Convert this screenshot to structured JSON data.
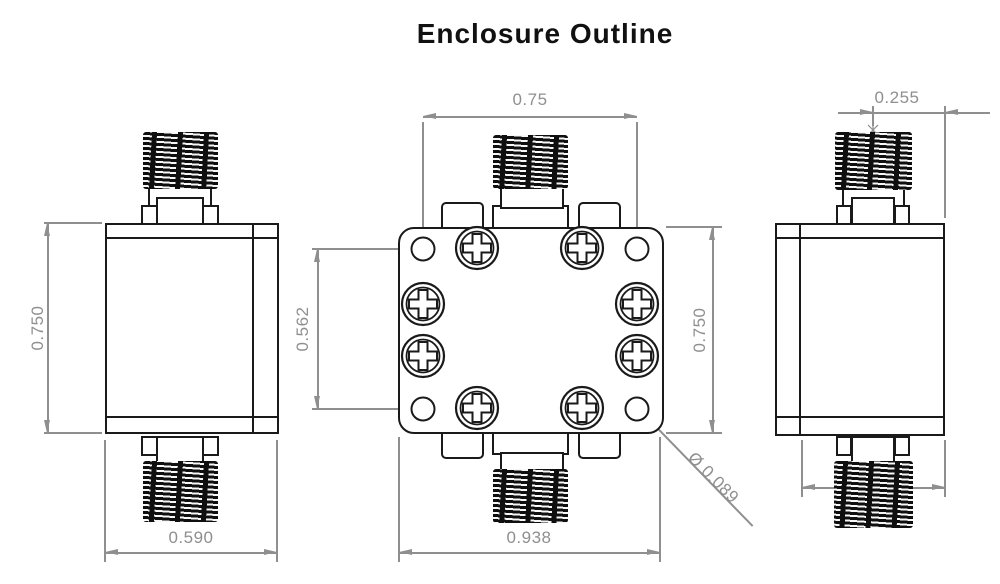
{
  "title": "Enclosure Outline",
  "dims": {
    "left_view": {
      "height": "0.750",
      "width": "0.590"
    },
    "top_view": {
      "hole_spacing_horizontal": "0.75",
      "hole_spacing_vertical": "0.562",
      "body_height": "0.750",
      "body_width": "0.938",
      "hole_diameter": "Ø 0.089"
    },
    "right_view": {
      "connector_offset": "0.255",
      "bottom_width": "0.500"
    }
  },
  "colors": {
    "line": "#1a1a1a",
    "dimension": "#8f8f8f",
    "background": "#ffffff"
  }
}
